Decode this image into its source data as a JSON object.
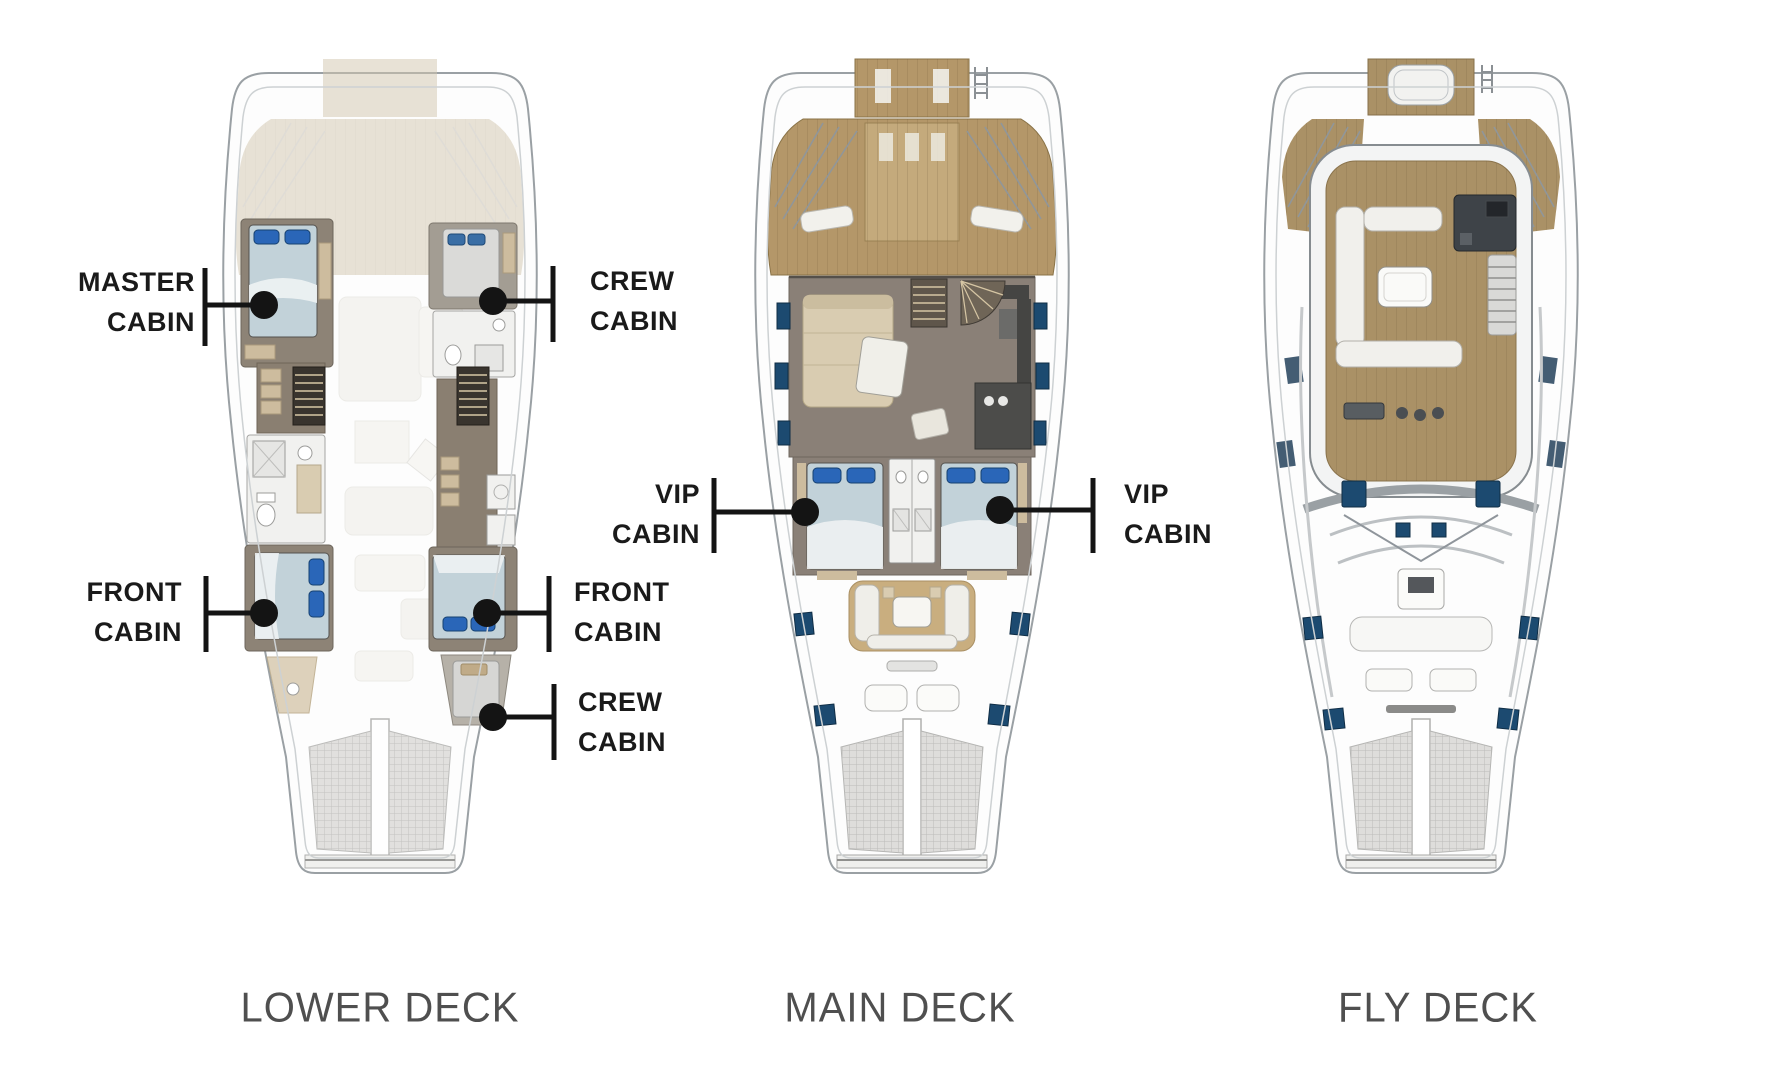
{
  "diagram_title": "Catamaran yacht deck plans",
  "decks": [
    {
      "id": "lower-deck",
      "label": "LOWER DECK"
    },
    {
      "id": "main-deck",
      "label": "MAIN DECK"
    },
    {
      "id": "fly-deck",
      "label": "FLY DECK"
    }
  ],
  "callouts": [
    {
      "id": "master-cabin",
      "deck": "lower-deck",
      "side": "left",
      "lines": [
        "MASTER",
        "CABIN"
      ]
    },
    {
      "id": "crew-cabin-aft",
      "deck": "lower-deck",
      "side": "right",
      "lines": [
        "CREW",
        "CABIN"
      ]
    },
    {
      "id": "front-cabin-port",
      "deck": "lower-deck",
      "side": "left",
      "lines": [
        "FRONT",
        "CABIN"
      ]
    },
    {
      "id": "front-cabin-stbd",
      "deck": "lower-deck",
      "side": "right",
      "lines": [
        "FRONT",
        "CABIN"
      ]
    },
    {
      "id": "crew-cabin-bow",
      "deck": "lower-deck",
      "side": "right",
      "lines": [
        "CREW",
        "CABIN"
      ]
    },
    {
      "id": "vip-cabin-port",
      "deck": "main-deck",
      "side": "left",
      "lines": [
        "VIP",
        "CABIN"
      ]
    },
    {
      "id": "vip-cabin-stbd",
      "deck": "main-deck",
      "side": "right",
      "lines": [
        "VIP",
        "CABIN"
      ]
    }
  ],
  "colors": {
    "background": "#ffffff",
    "label_text": "#1a1a1a",
    "deck_title_text": "#4f4f4f",
    "leader_line": "#141414",
    "teak_wood": "#b49769",
    "teak_wood_fly": "#aa9166",
    "teak_wood_faded": "#d2c7ae",
    "saloon_floor": "#8a8077",
    "cabin_floor": "#8d8376",
    "corridor_floor": "#8a7f71",
    "furniture_beige": "#d9ccb1",
    "closet_beige": "#cdbc9e",
    "bed_cover": "#c2d2d9",
    "pillow_blue": "#2a66b8",
    "window_navy": "#1c4a70",
    "hull_outline": "#9aa0a4",
    "trampoline": "#dedddb",
    "bathroom_white": "#f1f1ef",
    "stair_dark": "#39342e",
    "galley_dark": "#454543",
    "helm_dark": "#3e4348"
  }
}
